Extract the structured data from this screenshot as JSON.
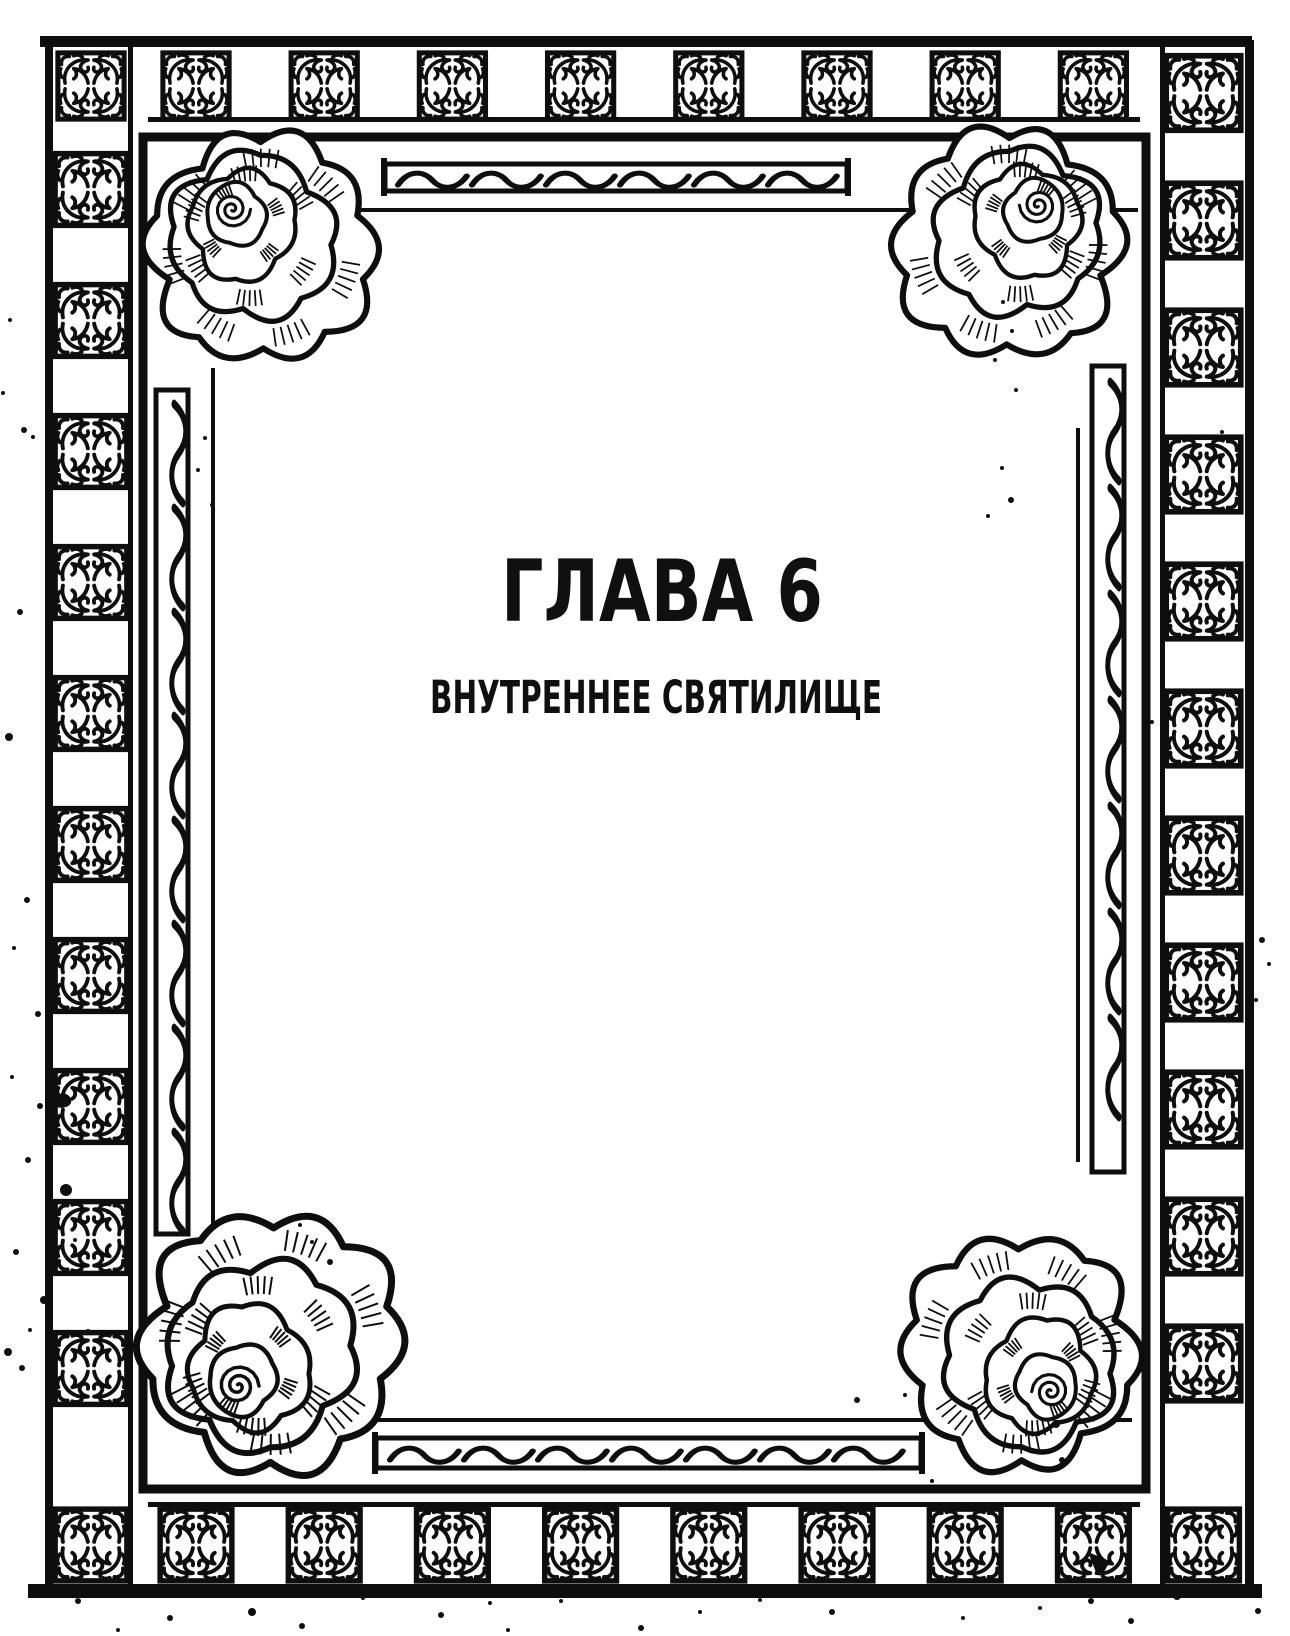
{
  "page": {
    "title": "ГЛАВА 6",
    "subtitle": "ВНУТРЕННЕЕ СВЯТИЛИЩЕ"
  },
  "colors": {
    "ink": "#0e0e0e",
    "paper": "#ffffff"
  },
  "decor": {
    "border_tile_icon": "quatrefoil-vine-tile",
    "corner_ornament_icon": "rose-flower",
    "scroll_bar_icon": "wavy-scroll-bar",
    "texture_icon": "ink-splatter"
  }
}
